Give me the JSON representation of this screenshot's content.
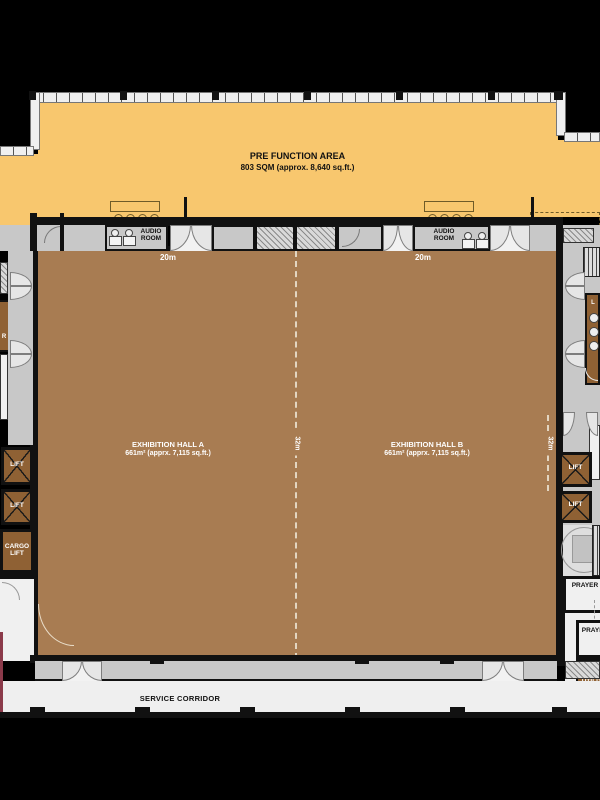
{
  "plan_title": {
    "pre_function_title": "PRE FUNCTION AREA",
    "pre_function_area": "803 SQM (approx. 8,640 sq.ft.)"
  },
  "rooms": {
    "audio_room": "AUDIO ROOM",
    "hall_a_name": "EXHIBITION HALL A",
    "hall_a_area": "661m² (apprx. 7,115 sq.ft.)",
    "hall_b_name": "EXHIBITION HALL B",
    "hall_b_area": "661m² (apprx. 7,115 sq.ft.)",
    "lift": "LIFT",
    "cargo_lift": "CARGO LIFT",
    "prayer_room_f": "PRAYER ROOM (F)",
    "prayer_room": "PRAYER ROOM",
    "utility_store": "UTILITY STORE",
    "ladies_room_initial": "L",
    "left_edge_room_initial": "R",
    "service_corridor": "SERVICE CORRIDOR"
  },
  "dimensions": {
    "hall_a_width": "20m",
    "hall_b_width": "20m",
    "hall_a_depth": "32m",
    "hall_b_depth": "32m"
  },
  "colors": {
    "pre_function_fill": "#F8C76E",
    "exhibition_hall_fill": "#A87C52",
    "lift_fill": "#8F6134",
    "corridor_fill": "#C8C8C8",
    "service_fill": "#EFEFEF",
    "wall": "#111111",
    "accent_edge_line": "#8B3A4A"
  }
}
